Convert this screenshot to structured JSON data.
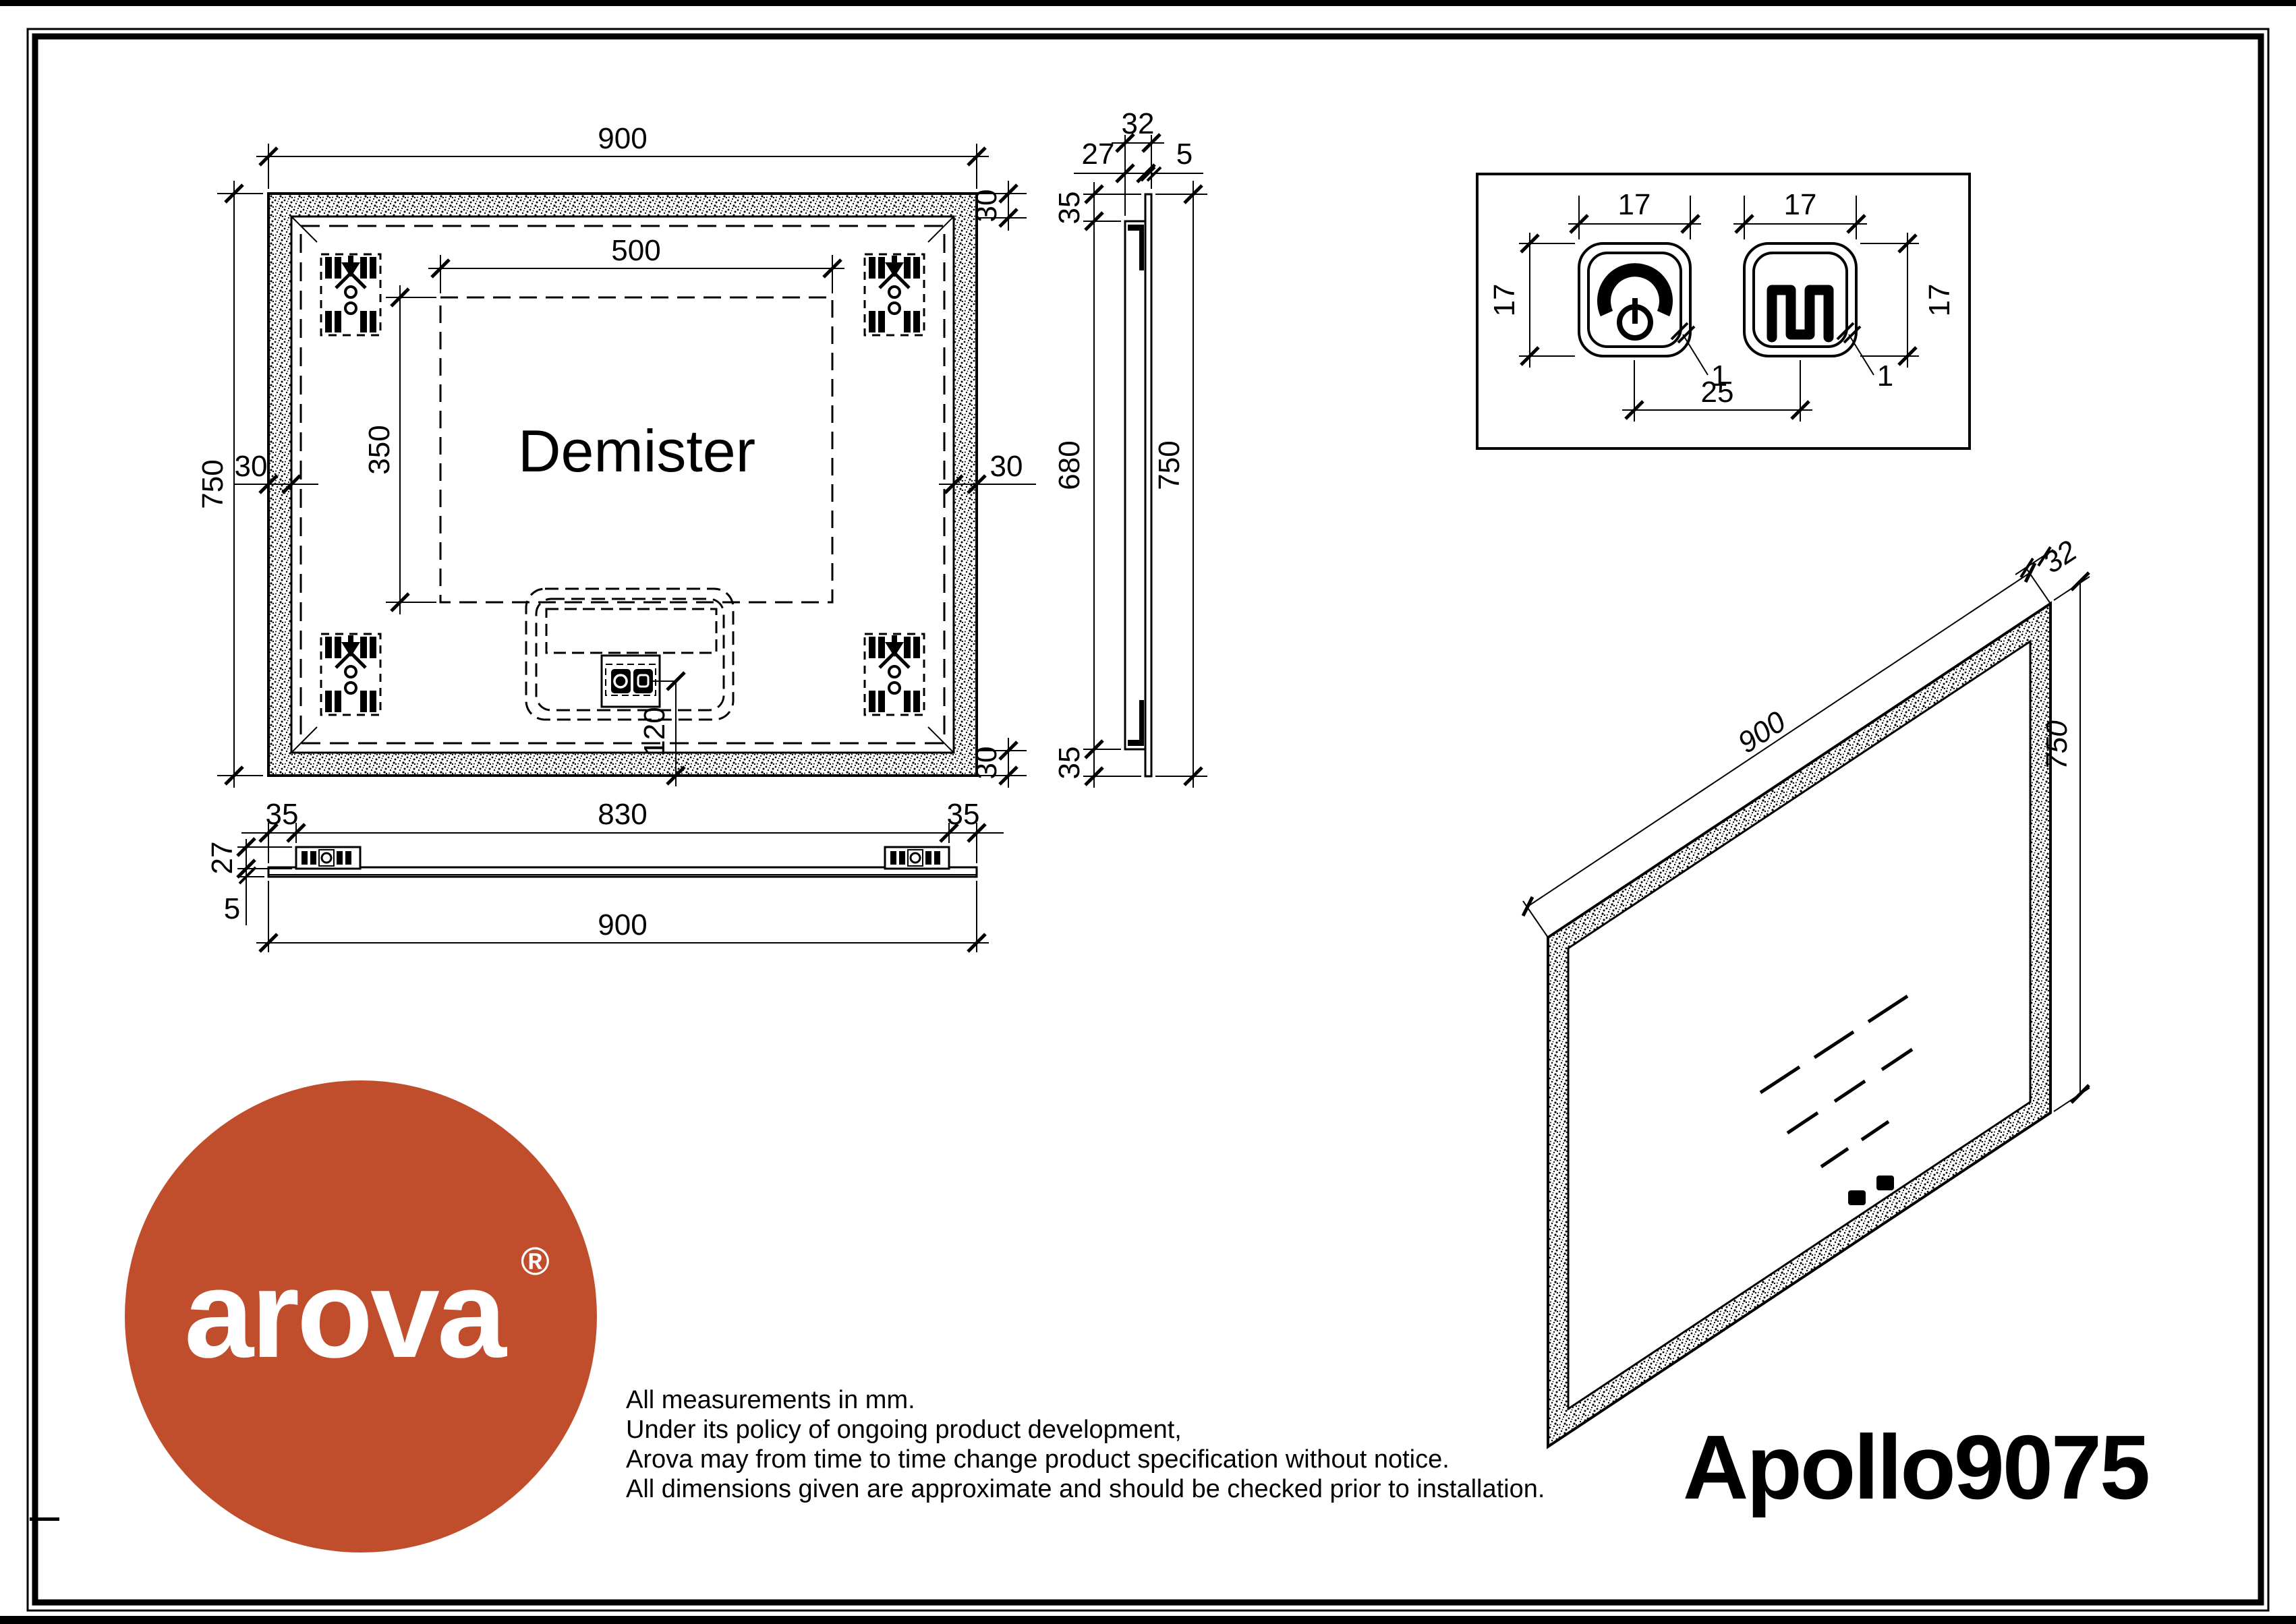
{
  "page": {
    "brand": "arova",
    "registered_mark": "®",
    "product_name": "Apollo9075",
    "accent_color": "#c04e2c",
    "disclaimer": [
      "All measurements in mm.",
      "Under its policy of ongoing product development,",
      "Arova may from time to time change product specification without notice.",
      "All dimensions given are approximate and should be checked prior to installation."
    ]
  },
  "front_view": {
    "demister_label": "Demister",
    "dim_width": "900",
    "dim_height": "750",
    "dim_demister_width": "500",
    "dim_demister_height": "350",
    "dim_border_left": "30",
    "dim_border_right": "30",
    "dim_border_top_right": "30",
    "dim_border_bottom_right": "30",
    "dim_sensor_bottom": "120"
  },
  "side_view": {
    "dim_total_thickness": "32",
    "dim_frame_depth": "27",
    "dim_glass_thickness": "5",
    "dim_top_inset": "35",
    "dim_frame_length": "680",
    "dim_height": "750",
    "dim_bottom_inset": "35"
  },
  "bottom_view": {
    "dim_left_inset": "35",
    "dim_bracket_span": "830",
    "dim_right_inset": "35",
    "dim_frame_depth": "27",
    "dim_glass_thickness": "5",
    "dim_width": "900"
  },
  "detail_view": {
    "dim_button1_width": "17",
    "dim_button2_width": "17",
    "dim_button1_height": "17",
    "dim_button2_height": "17",
    "dim_button_spacing": "25",
    "dim_corner_radius_1": "1",
    "dim_corner_radius_2": "1"
  },
  "iso_view": {
    "dim_width": "900",
    "dim_height": "750",
    "dim_thickness": "32"
  }
}
